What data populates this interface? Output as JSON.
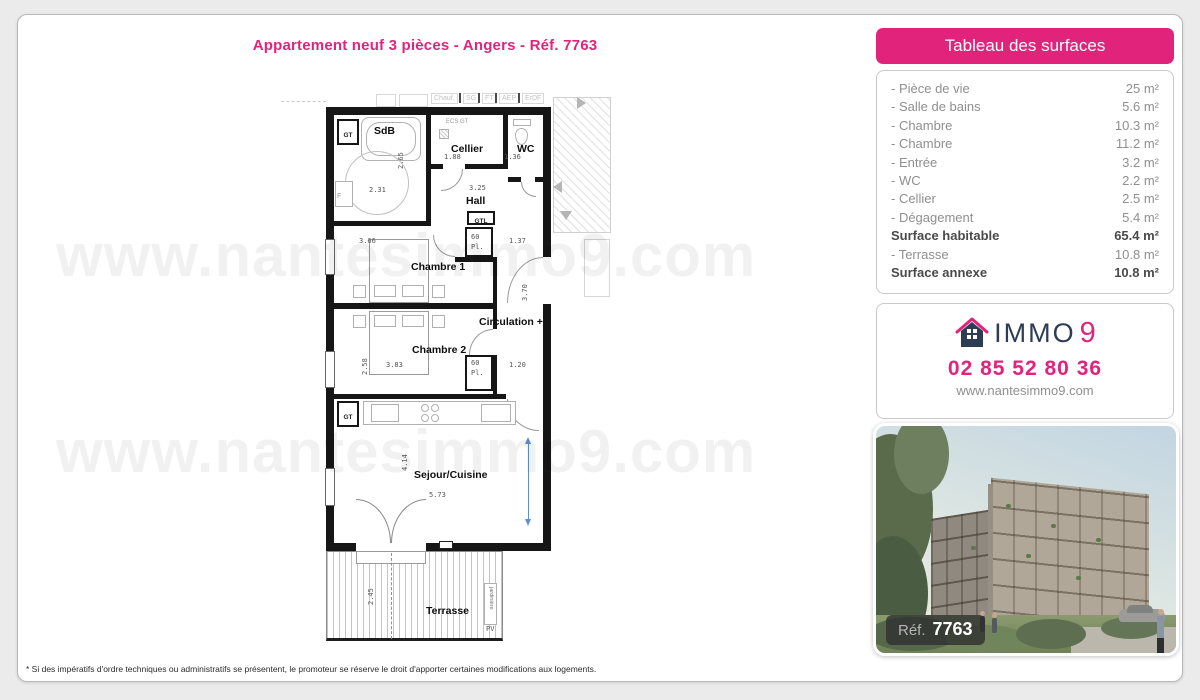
{
  "page": {
    "title": "Appartement neuf 3 pièces - Angers - Réf. 7763",
    "watermark": "www.nantesimmo9.com",
    "disclaimer": "* Si des impératifs d'ordre techniques ou administratifs se présentent, le promoteur se réserve le droit d'apporter certaines modifications aux logements."
  },
  "floor_plan": {
    "utilities": [
      "Chauf.",
      "SG",
      "FT",
      "AEP",
      "ErDF"
    ],
    "rooms": {
      "sdb": "SdB",
      "cellier": "Cellier",
      "wc": "WC",
      "hall": "Hall",
      "chambre1": "Chambre 1",
      "circulation": "Circulation +",
      "chambre2": "Chambre 2",
      "sejour": "Sejour/Cuisine",
      "terrasse": "Terrasse"
    },
    "annotations": {
      "gt": "GT",
      "gtl": "GTL",
      "ecs_gt": "ECS  GT",
      "pl": "Pl.",
      "f": "F",
      "pv": "PV",
      "jardiniere": "jardinière"
    },
    "dims": {
      "sdb_w": "2.31",
      "sdb_h": "2.65",
      "cellier_w": "1.88",
      "wc_w": "1.36",
      "hall_w": "3.25",
      "ch1_w": "3.66",
      "ch1_pl": "60",
      "ch1_r": "1.37",
      "circ_h": "3.70",
      "ch2_w": "3.83",
      "ch2_pl": "60",
      "ch2_r": "1.20",
      "ch2_h": "2.58",
      "sejour_w": "5.73",
      "sejour_h": "4.14",
      "terrasse_h": "2.45"
    }
  },
  "surfaces": {
    "title": "Tableau des surfaces",
    "rows": [
      {
        "label": "- Pièce de vie",
        "value": "25 m²"
      },
      {
        "label": "- Salle de bains",
        "value": "5.6 m²"
      },
      {
        "label": "- Chambre",
        "value": "10.3 m²"
      },
      {
        "label": "- Chambre",
        "value": "11.2 m²"
      },
      {
        "label": "- Entrée",
        "value": "3.2 m²"
      },
      {
        "label": "- WC",
        "value": "2.2 m²"
      },
      {
        "label": "- Cellier",
        "value": "2.5 m²"
      },
      {
        "label": "- Dégagement",
        "value": "5.4 m²"
      },
      {
        "label": "Surface habitable",
        "value": "65.4 m²",
        "bold": true
      },
      {
        "label": "- Terrasse",
        "value": "10.8 m²"
      },
      {
        "label": "Surface annexe",
        "value": "10.8 m²",
        "bold": true
      }
    ]
  },
  "contact": {
    "brand_name": "IMMO",
    "brand_digit": "9",
    "phone": "02 85 52 80 36",
    "website": "www.nantesimmo9.com"
  },
  "photo": {
    "ref_label": "Réf.",
    "ref_number": "7763"
  },
  "colors": {
    "accent_pink": "#e2237c",
    "brand_navy": "#2e3d54"
  }
}
